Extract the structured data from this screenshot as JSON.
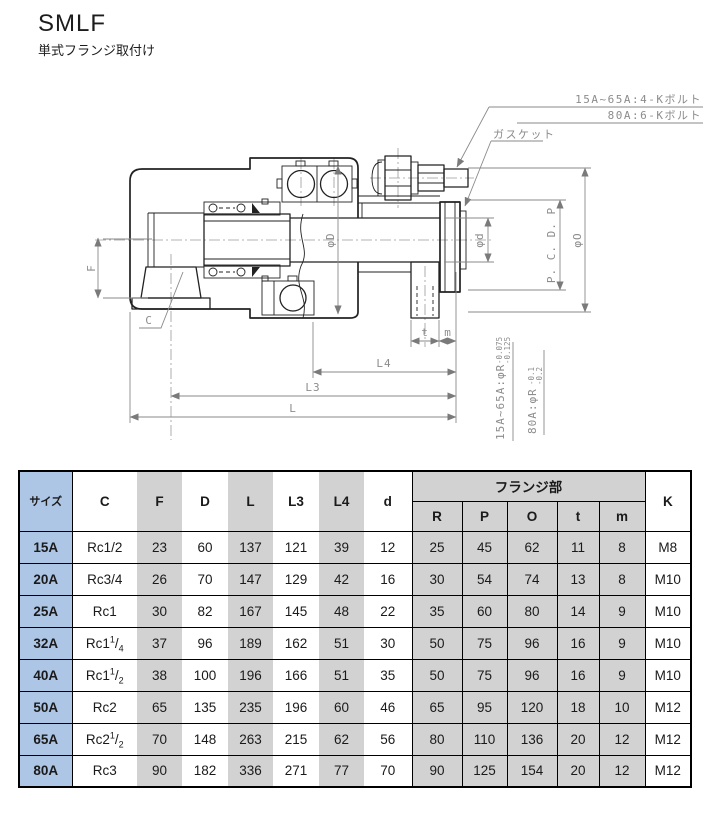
{
  "page": {
    "title": "SMLF",
    "subtitle": "単式フランジ取付け"
  },
  "drawing": {
    "notes": {
      "bolt_note_1": "15A~65A:4-Kボルト",
      "bolt_note_2": "80A:6-Kボルト",
      "gasket": "ガスケット",
      "tol_note_1": {
        "prefix": "15A~65A:φR",
        "upper": "-0.075",
        "lower": "-0.125"
      },
      "tol_note_2": {
        "prefix": "80A:φR",
        "upper": "-0.1",
        "lower": "-0.2"
      }
    },
    "dims": {
      "f": "F",
      "c": "C",
      "phiD": "φD",
      "phid": "φd",
      "pcdp": "P. C. D. P",
      "phiO": "φO",
      "t": "t",
      "m": "m",
      "l4": "L4",
      "l3": "L3",
      "l": "L"
    }
  },
  "table": {
    "colors": {
      "size_column": "#aec6e5",
      "stripe": "#d2d2d2",
      "border": "#000000"
    },
    "headers": {
      "size": "サイズ",
      "c": "C",
      "f": "F",
      "d_outer": "D",
      "l": "L",
      "l3": "L3",
      "l4": "L4",
      "d": "d",
      "flange_group": "フランジ部",
      "r": "R",
      "p": "P",
      "o": "O",
      "t": "t",
      "m": "m",
      "k": "K"
    },
    "rows": [
      {
        "size": "15A",
        "c": "Rc1/2",
        "c_sup": "",
        "c_slash": "",
        "c_sub": "",
        "f": "23",
        "dd": "60",
        "l": "137",
        "l3": "121",
        "l4": "39",
        "d": "12",
        "r": "25",
        "p": "45",
        "o": "62",
        "t": "11",
        "m": "8",
        "k": "M8"
      },
      {
        "size": "20A",
        "c": "Rc3/4",
        "c_sup": "",
        "c_slash": "",
        "c_sub": "",
        "f": "26",
        "dd": "70",
        "l": "147",
        "l3": "129",
        "l4": "42",
        "d": "16",
        "r": "30",
        "p": "54",
        "o": "74",
        "t": "13",
        "m": "8",
        "k": "M10"
      },
      {
        "size": "25A",
        "c": "Rc1",
        "c_sup": "",
        "c_slash": "",
        "c_sub": "",
        "f": "30",
        "dd": "82",
        "l": "167",
        "l3": "145",
        "l4": "48",
        "d": "22",
        "r": "35",
        "p": "60",
        "o": "80",
        "t": "14",
        "m": "9",
        "k": "M10"
      },
      {
        "size": "32A",
        "c": "Rc1",
        "c_sup": "1",
        "c_slash": "/",
        "c_sub": "4",
        "f": "37",
        "dd": "96",
        "l": "189",
        "l3": "162",
        "l4": "51",
        "d": "30",
        "r": "50",
        "p": "75",
        "o": "96",
        "t": "16",
        "m": "9",
        "k": "M10"
      },
      {
        "size": "40A",
        "c": "Rc1",
        "c_sup": "1",
        "c_slash": "/",
        "c_sub": "2",
        "f": "38",
        "dd": "100",
        "l": "196",
        "l3": "166",
        "l4": "51",
        "d": "35",
        "r": "50",
        "p": "75",
        "o": "96",
        "t": "16",
        "m": "9",
        "k": "M10"
      },
      {
        "size": "50A",
        "c": "Rc2",
        "c_sup": "",
        "c_slash": "",
        "c_sub": "",
        "f": "65",
        "dd": "135",
        "l": "235",
        "l3": "196",
        "l4": "60",
        "d": "46",
        "r": "65",
        "p": "95",
        "o": "120",
        "t": "18",
        "m": "10",
        "k": "M12"
      },
      {
        "size": "65A",
        "c": "Rc2",
        "c_sup": "1",
        "c_slash": "/",
        "c_sub": "2",
        "f": "70",
        "dd": "148",
        "l": "263",
        "l3": "215",
        "l4": "62",
        "d": "56",
        "r": "80",
        "p": "110",
        "o": "136",
        "t": "20",
        "m": "12",
        "k": "M12"
      },
      {
        "size": "80A",
        "c": "Rc3",
        "c_sup": "",
        "c_slash": "",
        "c_sub": "",
        "f": "90",
        "dd": "182",
        "l": "336",
        "l3": "271",
        "l4": "77",
        "d": "70",
        "r": "90",
        "p": "125",
        "o": "154",
        "t": "20",
        "m": "12",
        "k": "M12"
      }
    ]
  }
}
